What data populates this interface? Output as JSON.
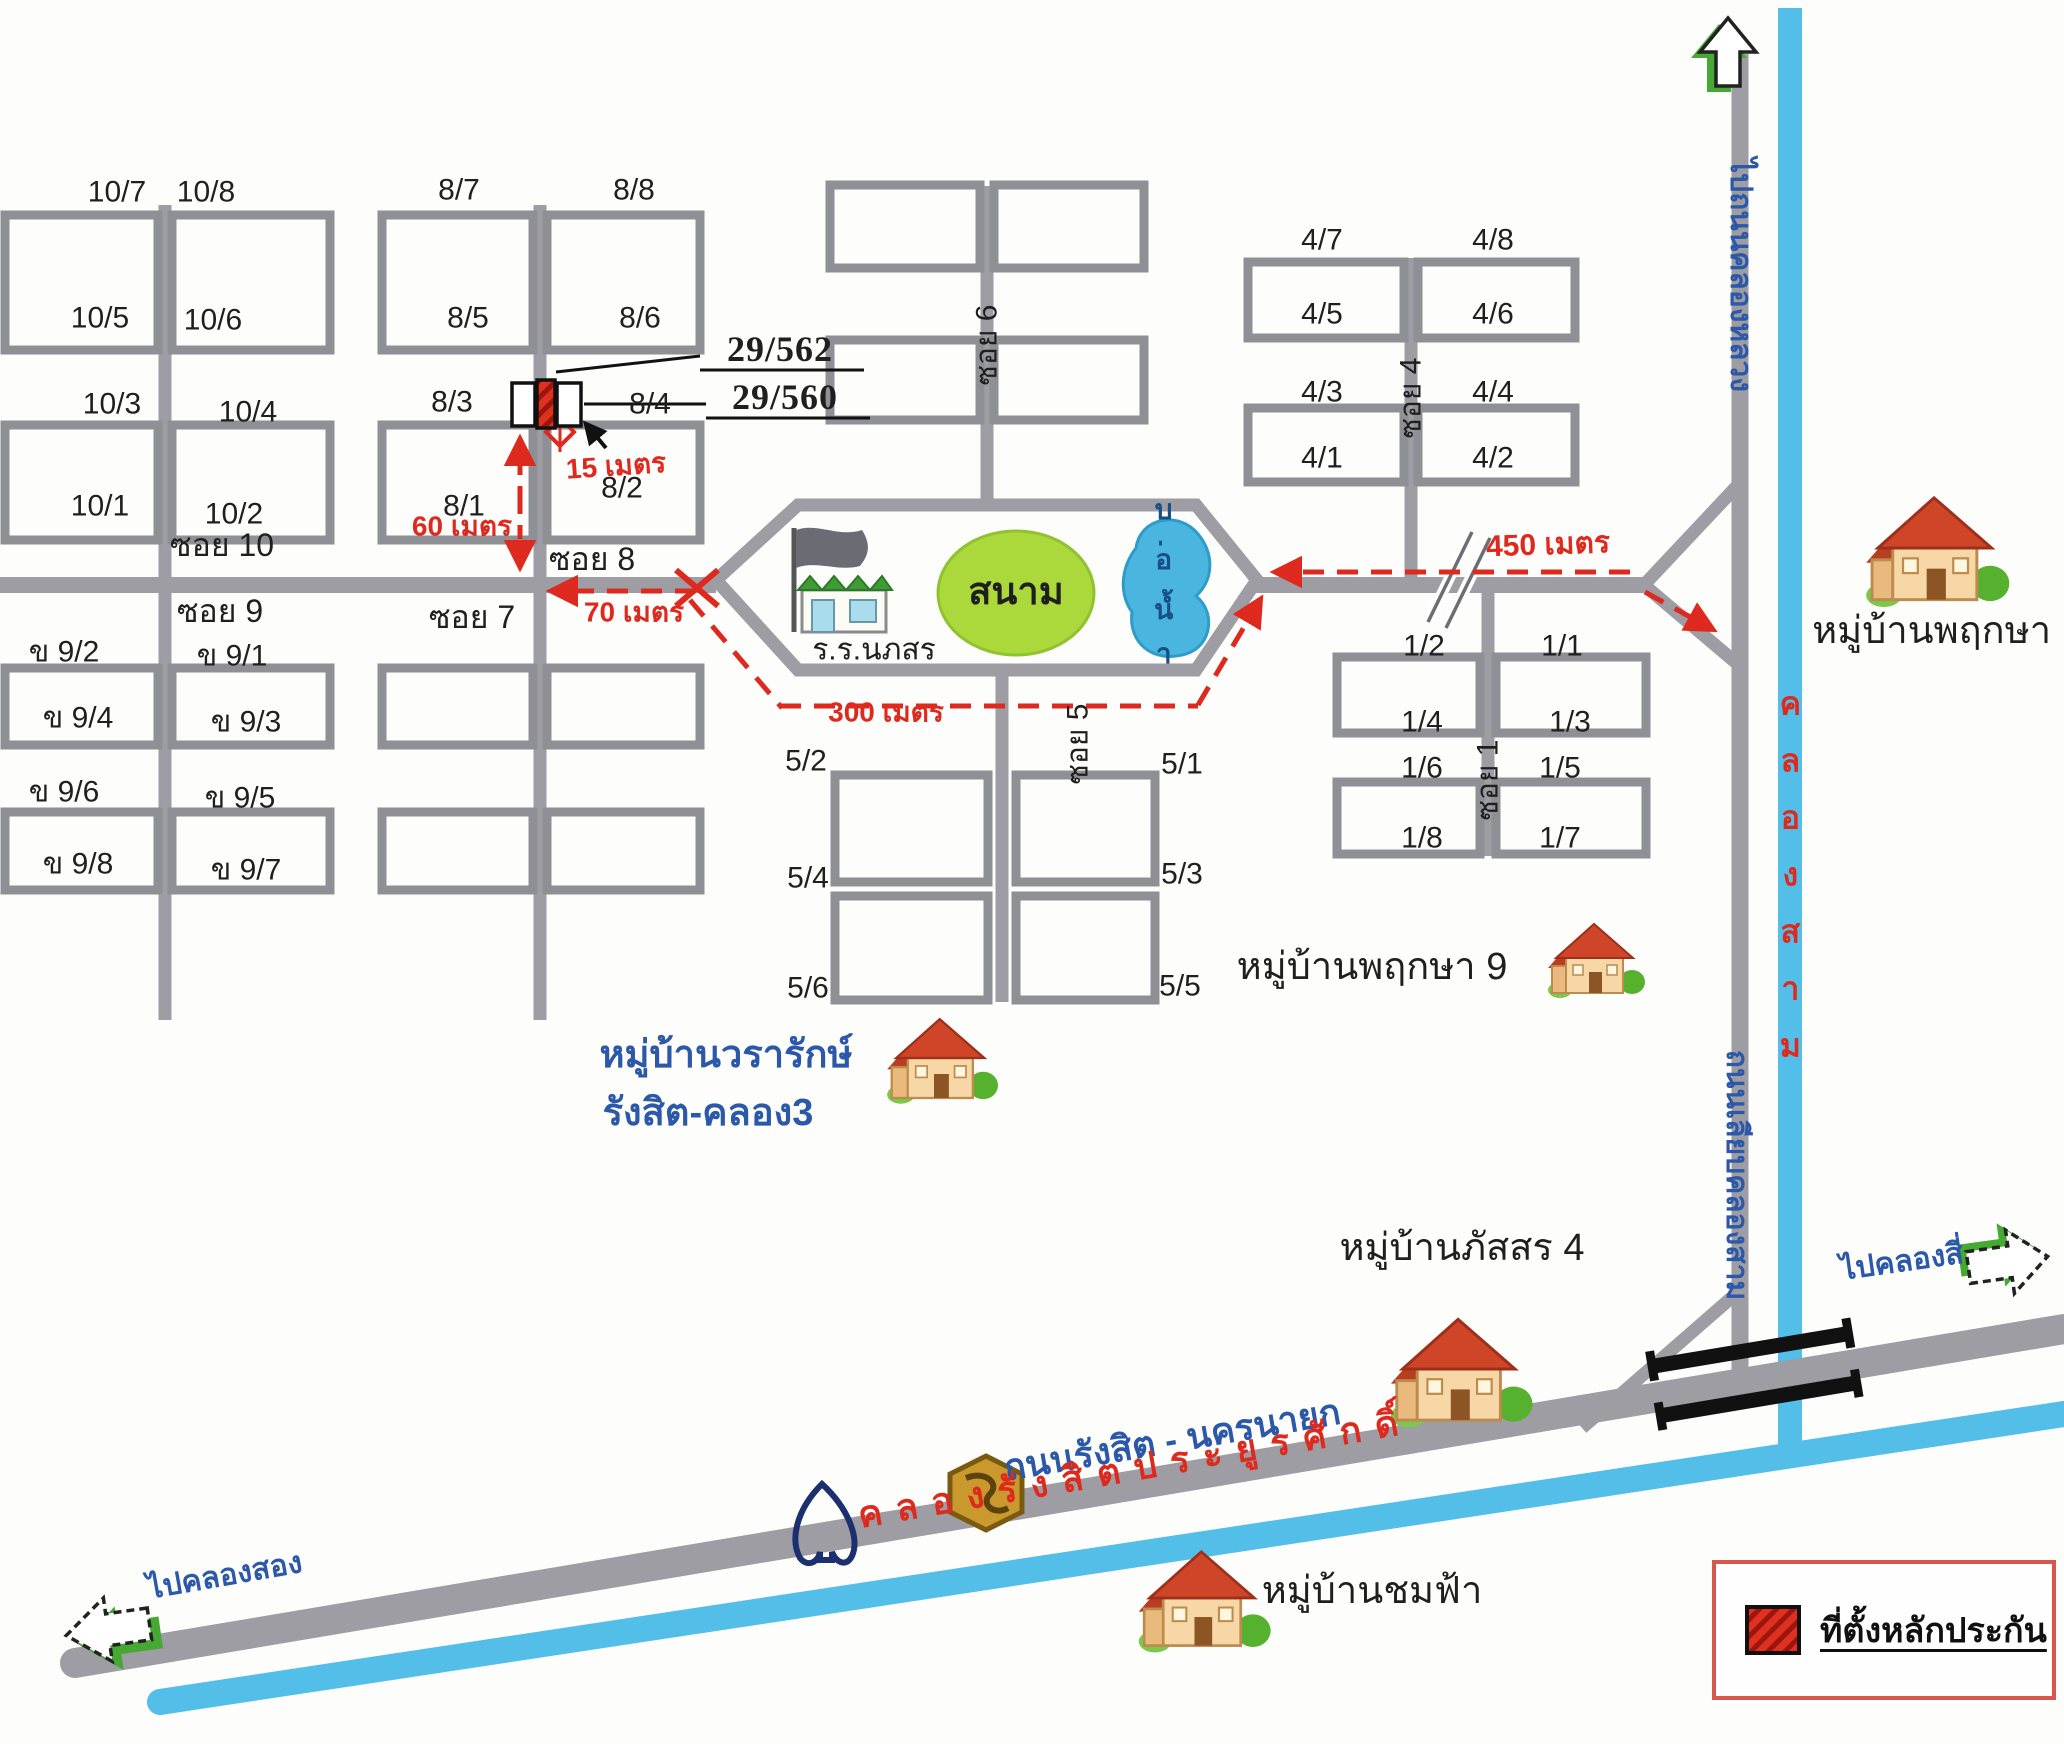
{
  "legend": {
    "label": "ที่ตั้งหลักประกัน",
    "swatch": "red-hatch-square"
  },
  "colors": {
    "road": "#9d9da3",
    "plot_stroke": "#8f8f96",
    "canal": "#53bfe8",
    "red": "#de2a1e",
    "blue_text": "#2b58a8",
    "field_green": "#abd93c",
    "pond_blue": "#4ab5de",
    "legend_border": "#d9564e",
    "arrow_green": "#45a934"
  },
  "labels": [
    {
      "n": "plot-10-7",
      "t": "10/7",
      "x": 117,
      "y": 192
    },
    {
      "n": "plot-10-8",
      "t": "10/8",
      "x": 206,
      "y": 192
    },
    {
      "n": "plot-10-5",
      "t": "10/5",
      "x": 100,
      "y": 318
    },
    {
      "n": "plot-10-6",
      "t": "10/6",
      "x": 213,
      "y": 320
    },
    {
      "n": "plot-10-3",
      "t": "10/3",
      "x": 112,
      "y": 404
    },
    {
      "n": "plot-10-4",
      "t": "10/4",
      "x": 248,
      "y": 412
    },
    {
      "n": "plot-10-1",
      "t": "10/1",
      "x": 100,
      "y": 506
    },
    {
      "n": "plot-10-2",
      "t": "10/2",
      "x": 234,
      "y": 514
    },
    {
      "n": "plot-8-7",
      "t": "8/7",
      "x": 459,
      "y": 190
    },
    {
      "n": "plot-8-8",
      "t": "8/8",
      "x": 634,
      "y": 190
    },
    {
      "n": "plot-8-5",
      "t": "8/5",
      "x": 468,
      "y": 318
    },
    {
      "n": "plot-8-6",
      "t": "8/6",
      "x": 640,
      "y": 318
    },
    {
      "n": "plot-8-3",
      "t": "8/3",
      "x": 452,
      "y": 402
    },
    {
      "n": "plot-8-4",
      "t": "8/4",
      "x": 650,
      "y": 404
    },
    {
      "n": "plot-8-1",
      "t": "8/1",
      "x": 464,
      "y": 506
    },
    {
      "n": "plot-8-2",
      "t": "8/2",
      "x": 622,
      "y": 488
    },
    {
      "n": "plot-4-7",
      "t": "4/7",
      "x": 1322,
      "y": 240
    },
    {
      "n": "plot-4-8",
      "t": "4/8",
      "x": 1493,
      "y": 240
    },
    {
      "n": "plot-4-5",
      "t": "4/5",
      "x": 1322,
      "y": 314
    },
    {
      "n": "plot-4-6",
      "t": "4/6",
      "x": 1493,
      "y": 314
    },
    {
      "n": "plot-4-3",
      "t": "4/3",
      "x": 1322,
      "y": 392
    },
    {
      "n": "plot-4-4",
      "t": "4/4",
      "x": 1493,
      "y": 392
    },
    {
      "n": "plot-4-1",
      "t": "4/1",
      "x": 1322,
      "y": 458
    },
    {
      "n": "plot-4-2",
      "t": "4/2",
      "x": 1493,
      "y": 458
    },
    {
      "n": "plot-1-2",
      "t": "1/2",
      "x": 1424,
      "y": 646
    },
    {
      "n": "plot-1-1",
      "t": "1/1",
      "x": 1562,
      "y": 646
    },
    {
      "n": "plot-1-4",
      "t": "1/4",
      "x": 1422,
      "y": 722
    },
    {
      "n": "plot-1-3",
      "t": "1/3",
      "x": 1570,
      "y": 722
    },
    {
      "n": "plot-1-6",
      "t": "1/6",
      "x": 1422,
      "y": 768
    },
    {
      "n": "plot-1-5",
      "t": "1/5",
      "x": 1560,
      "y": 768
    },
    {
      "n": "plot-1-8",
      "t": "1/8",
      "x": 1422,
      "y": 838
    },
    {
      "n": "plot-1-7",
      "t": "1/7",
      "x": 1560,
      "y": 838
    },
    {
      "n": "plot-5-2",
      "t": "5/2",
      "x": 806,
      "y": 761
    },
    {
      "n": "plot-5-1",
      "t": "5/1",
      "x": 1182,
      "y": 764
    },
    {
      "n": "plot-5-4",
      "t": "5/4",
      "x": 808,
      "y": 878
    },
    {
      "n": "plot-5-3",
      "t": "5/3",
      "x": 1182,
      "y": 874
    },
    {
      "n": "plot-5-6",
      "t": "5/6",
      "x": 808,
      "y": 988
    },
    {
      "n": "plot-5-5",
      "t": "5/5",
      "x": 1180,
      "y": 986
    },
    {
      "n": "plot-9-2",
      "t": "ข 9/2",
      "x": 64,
      "y": 652
    },
    {
      "n": "plot-9-1",
      "t": "ข 9/1",
      "x": 232,
      "y": 656
    },
    {
      "n": "plot-9-4",
      "t": "ข 9/4",
      "x": 78,
      "y": 718
    },
    {
      "n": "plot-9-3",
      "t": "ข 9/3",
      "x": 246,
      "y": 722
    },
    {
      "n": "plot-9-6",
      "t": "ข 9/6",
      "x": 64,
      "y": 792
    },
    {
      "n": "plot-9-5",
      "t": "ข 9/5",
      "x": 240,
      "y": 798
    },
    {
      "n": "plot-9-8",
      "t": "ข 9/8",
      "x": 78,
      "y": 864
    },
    {
      "n": "plot-9-7",
      "t": "ข 9/7",
      "x": 246,
      "y": 870
    },
    {
      "n": "soi-10-label",
      "t": "ซอย 10",
      "x": 222,
      "y": 546,
      "s": 32
    },
    {
      "n": "soi-8-label",
      "t": "ซอย 8",
      "x": 592,
      "y": 560,
      "s": 32
    },
    {
      "n": "soi-9-label",
      "t": "ซอย 9",
      "x": 220,
      "y": 612,
      "s": 32
    },
    {
      "n": "soi-7-label",
      "t": "ซอย 7",
      "x": 472,
      "y": 618,
      "s": 32
    },
    {
      "n": "soi-6-label",
      "t": "ซอย 6",
      "x": 987,
      "y": 345,
      "s": 30,
      "r": -90
    },
    {
      "n": "soi-4-label",
      "t": "ซอย 4",
      "x": 1411,
      "y": 398,
      "s": 30,
      "r": -90
    },
    {
      "n": "soi-5-label",
      "t": "ซอย 5",
      "x": 1078,
      "y": 744,
      "s": 30,
      "r": -90
    },
    {
      "n": "soi-1-label",
      "t": "ซอย 1",
      "x": 1488,
      "y": 780,
      "s": 30,
      "r": -90
    },
    {
      "n": "address-29-562",
      "t": "29/562",
      "x": 780,
      "y": 350,
      "s": 36,
      "c": "c-black serif"
    },
    {
      "n": "address-29-560",
      "t": "29/560",
      "x": 785,
      "y": 398,
      "s": 36,
      "c": "c-black serif"
    },
    {
      "n": "distance-15m",
      "t": "15 เมตร",
      "x": 616,
      "y": 466,
      "s": 28,
      "c": "c-red",
      "r": -4
    },
    {
      "n": "distance-60m",
      "t": "60 เมตร",
      "x": 462,
      "y": 526,
      "s": 28,
      "c": "c-red"
    },
    {
      "n": "distance-70m",
      "t": "70 เมตร",
      "x": 634,
      "y": 612,
      "s": 28,
      "c": "c-red"
    },
    {
      "n": "distance-300m",
      "t": "300 เมตร",
      "x": 886,
      "y": 712,
      "s": 28,
      "c": "c-red"
    },
    {
      "n": "distance-450m",
      "t": "450 เมตร",
      "x": 1548,
      "y": 545,
      "s": 30,
      "c": "c-red",
      "r": -2
    },
    {
      "n": "village-wararak-line1",
      "t": "หมู่บ้านวรารักษ์",
      "x": 726,
      "y": 1056,
      "s": 38,
      "c": "c-blue"
    },
    {
      "n": "village-wararak-line2",
      "t": "รังสิต-คลอง3",
      "x": 708,
      "y": 1114,
      "s": 38,
      "c": "c-blue"
    },
    {
      "n": "village-pruksa9",
      "t": "หมู่บ้านพฤกษา 9",
      "x": 1372,
      "y": 968,
      "s": 38
    },
    {
      "n": "village-pruksa12",
      "t": "หมู่บ้านพฤกษา 12",
      "x": 1958,
      "y": 632,
      "s": 38
    },
    {
      "n": "village-passorn4",
      "t": "หมู่บ้านภัสสร 4",
      "x": 1462,
      "y": 1249,
      "s": 38
    },
    {
      "n": "village-chomfah",
      "t": "หมู่บ้านชมฟ้า",
      "x": 1372,
      "y": 1592,
      "s": 38
    },
    {
      "n": "to-khlong-song",
      "t": "ไปคลองสอง",
      "x": 225,
      "y": 1576,
      "s": 30,
      "c": "c-blue",
      "r": -10
    },
    {
      "n": "to-khlong-si",
      "t": "ไปคลองสี่",
      "x": 1902,
      "y": 1262,
      "s": 30,
      "c": "c-blue",
      "r": -8
    },
    {
      "n": "road-rangsit-nakhonnayok",
      "t": "ถนนรังสิต - นครนายก",
      "x": 1172,
      "y": 1440,
      "s": 36,
      "c": "c-blue",
      "r": -9.7
    },
    {
      "n": "to-khlong-luang-road",
      "t": "ไปถนนคลองหลวง",
      "x": 1740,
      "y": 275,
      "s": 30,
      "c": "c-blue vert"
    },
    {
      "n": "road-liab-khlong-sam",
      "t": "ถนนเลียบคลองสาม",
      "x": 1736,
      "y": 1175,
      "s": 30,
      "c": "c-blue vert"
    },
    {
      "n": "canal-khlong-sam",
      "t": "คลองสาม",
      "x": 1790,
      "y": 878,
      "s": 32,
      "c": "c-red upright"
    },
    {
      "n": "canal-rangsit-prayoonsak",
      "t": "คลองรังสิตประยูรศักดิ์",
      "x": 1135,
      "y": 1468,
      "s": 36,
      "c": "c-red",
      "r": -9.8,
      "ls": 14
    },
    {
      "n": "pond-label",
      "t": "บ่อน้ำ",
      "x": 1164,
      "y": 585,
      "s": 28,
      "c": "c-navy upright"
    },
    {
      "n": "field-label",
      "t": "สนาม",
      "x": 1016,
      "y": 593,
      "s": 38,
      "c": "c-black bold"
    },
    {
      "n": "school-label",
      "t": "ร.ร.นภสร",
      "x": 874,
      "y": 650,
      "s": 30
    }
  ]
}
